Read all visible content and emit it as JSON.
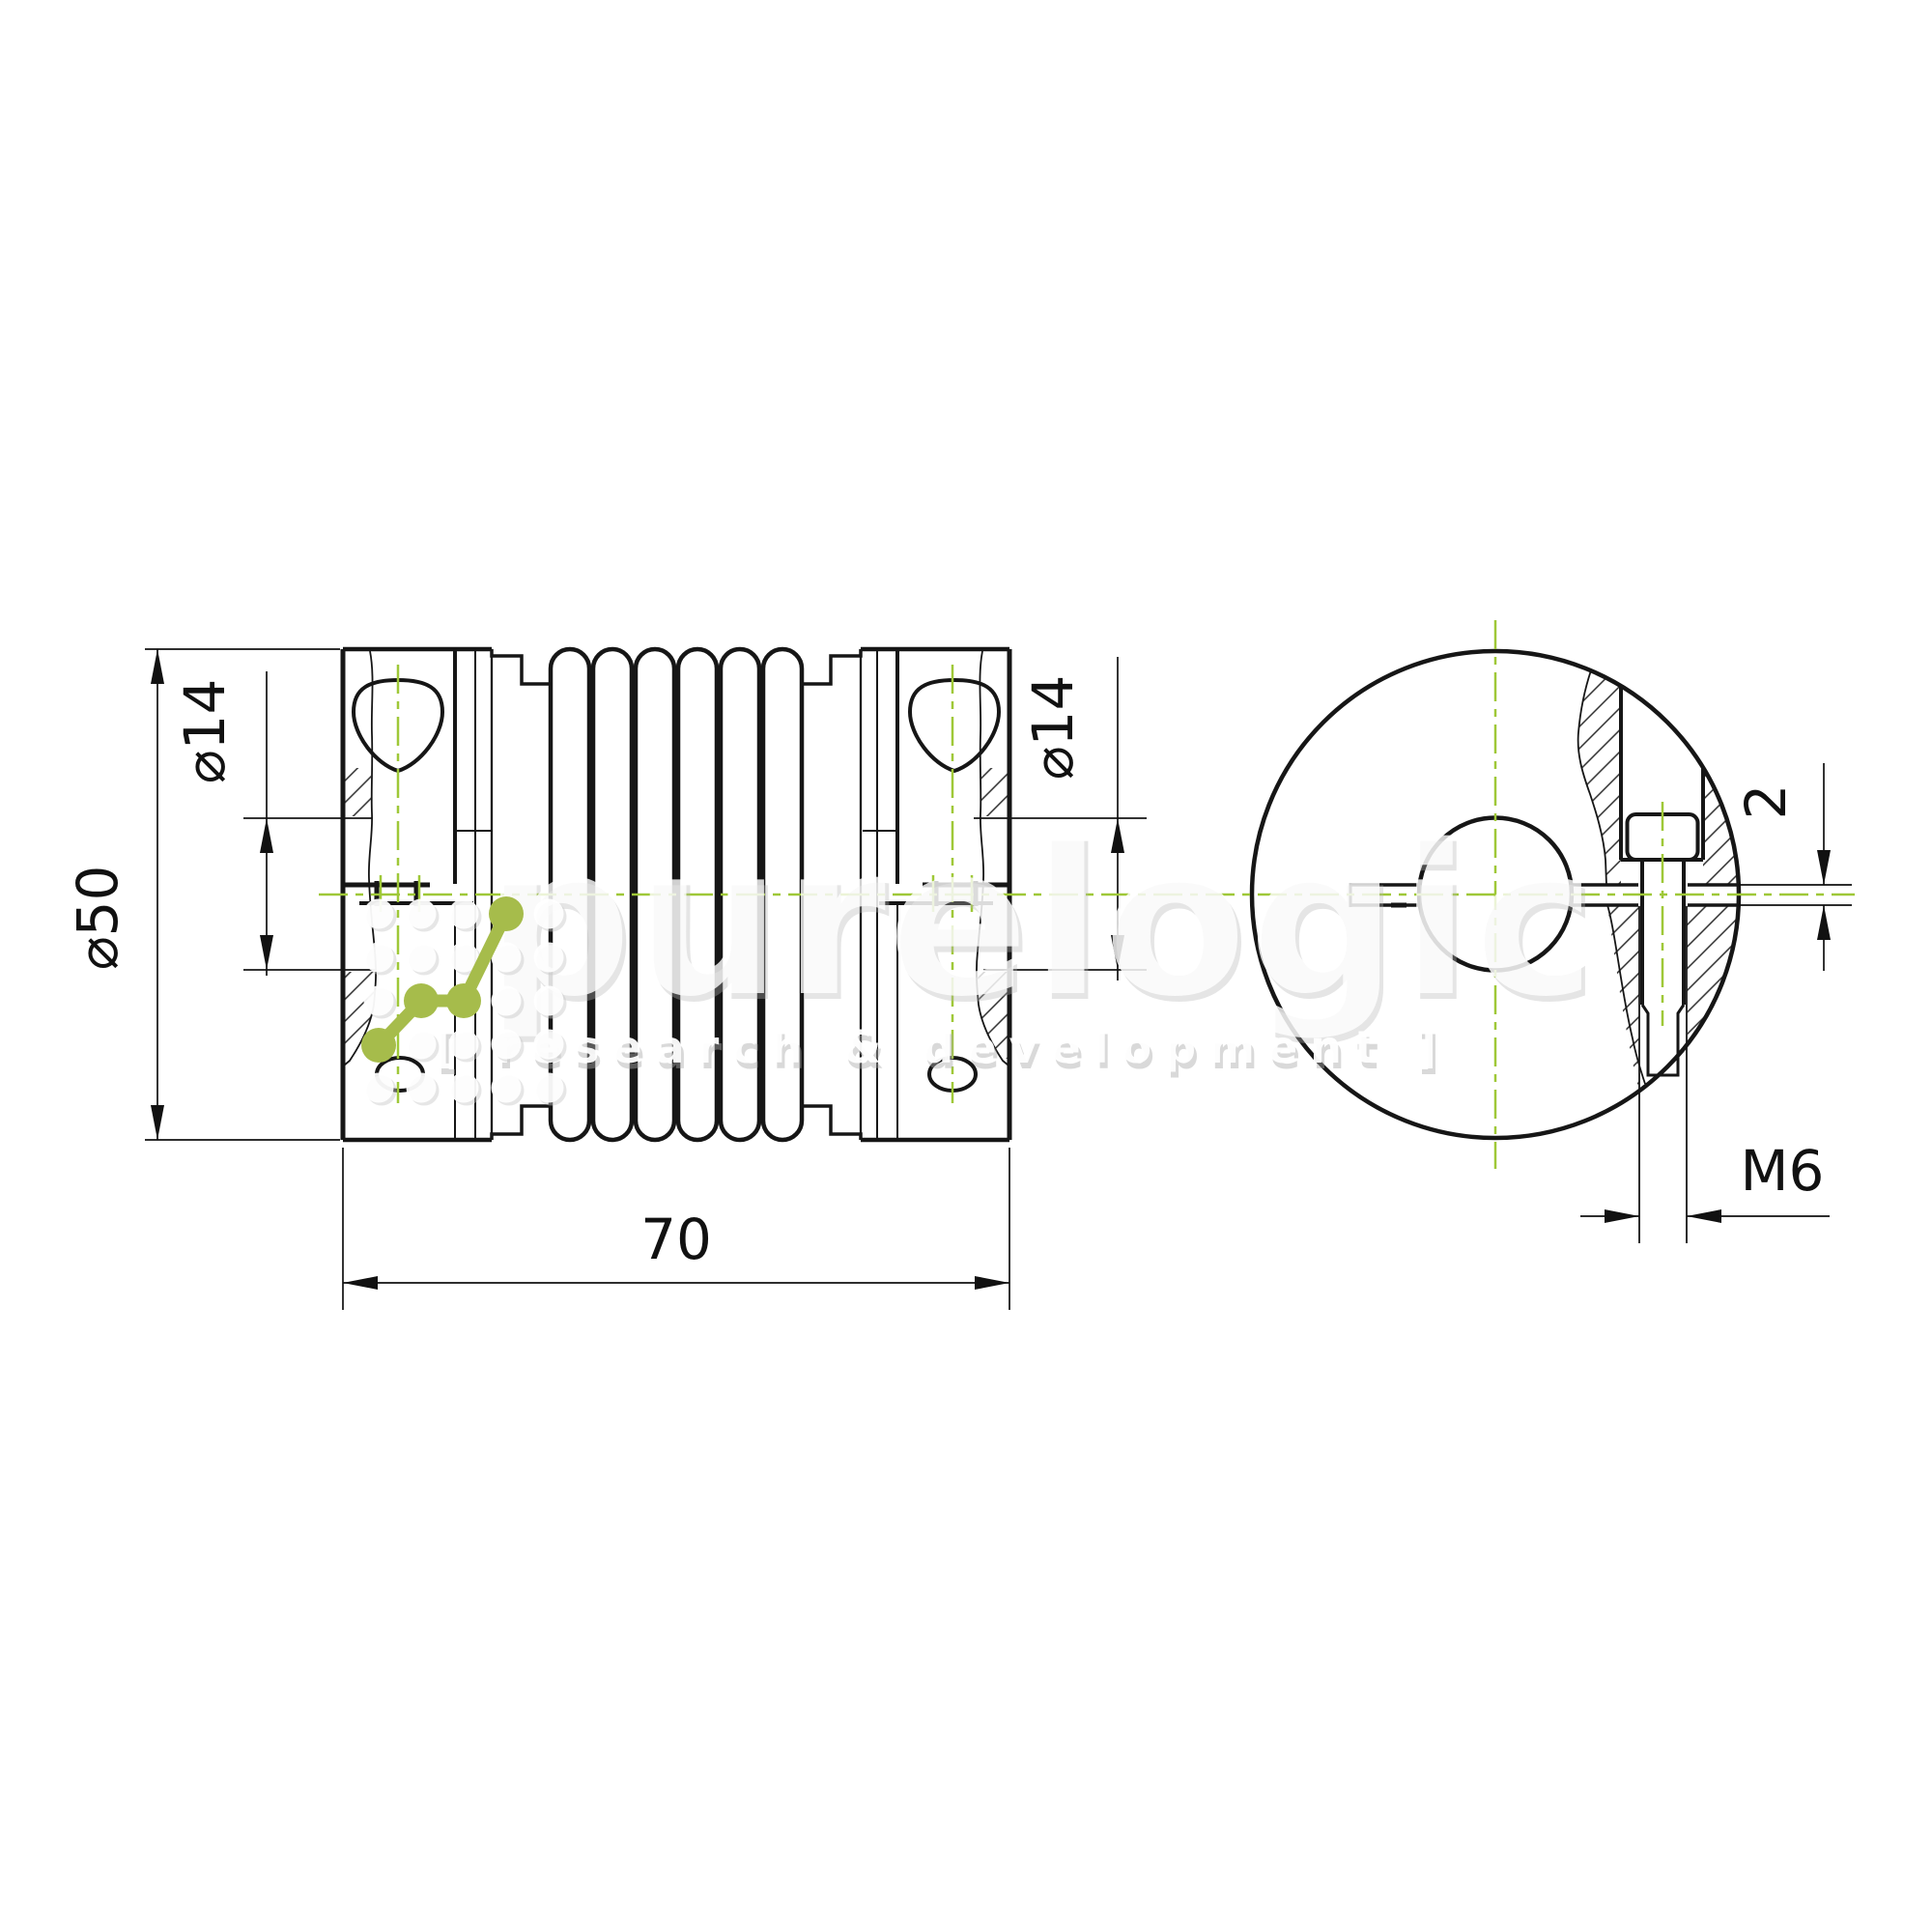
{
  "drawing": {
    "title": "bellows coupling technical drawing",
    "views": {
      "side_view": "left",
      "end_view": "right"
    }
  },
  "dims": {
    "outer_diameter": "⌀50",
    "bore_left": "⌀14",
    "bore_right": "⌀14",
    "overall_length": "70",
    "slot_width": "2",
    "thread": "M6"
  },
  "watermark": {
    "brand": "purelogic",
    "tagline": "[ research & development ]"
  },
  "colors": {
    "line": "#161616",
    "centerline_green": "#9fc838",
    "logo_green": "#a6bc4b",
    "watermark_gray": "#e4e4e4"
  }
}
